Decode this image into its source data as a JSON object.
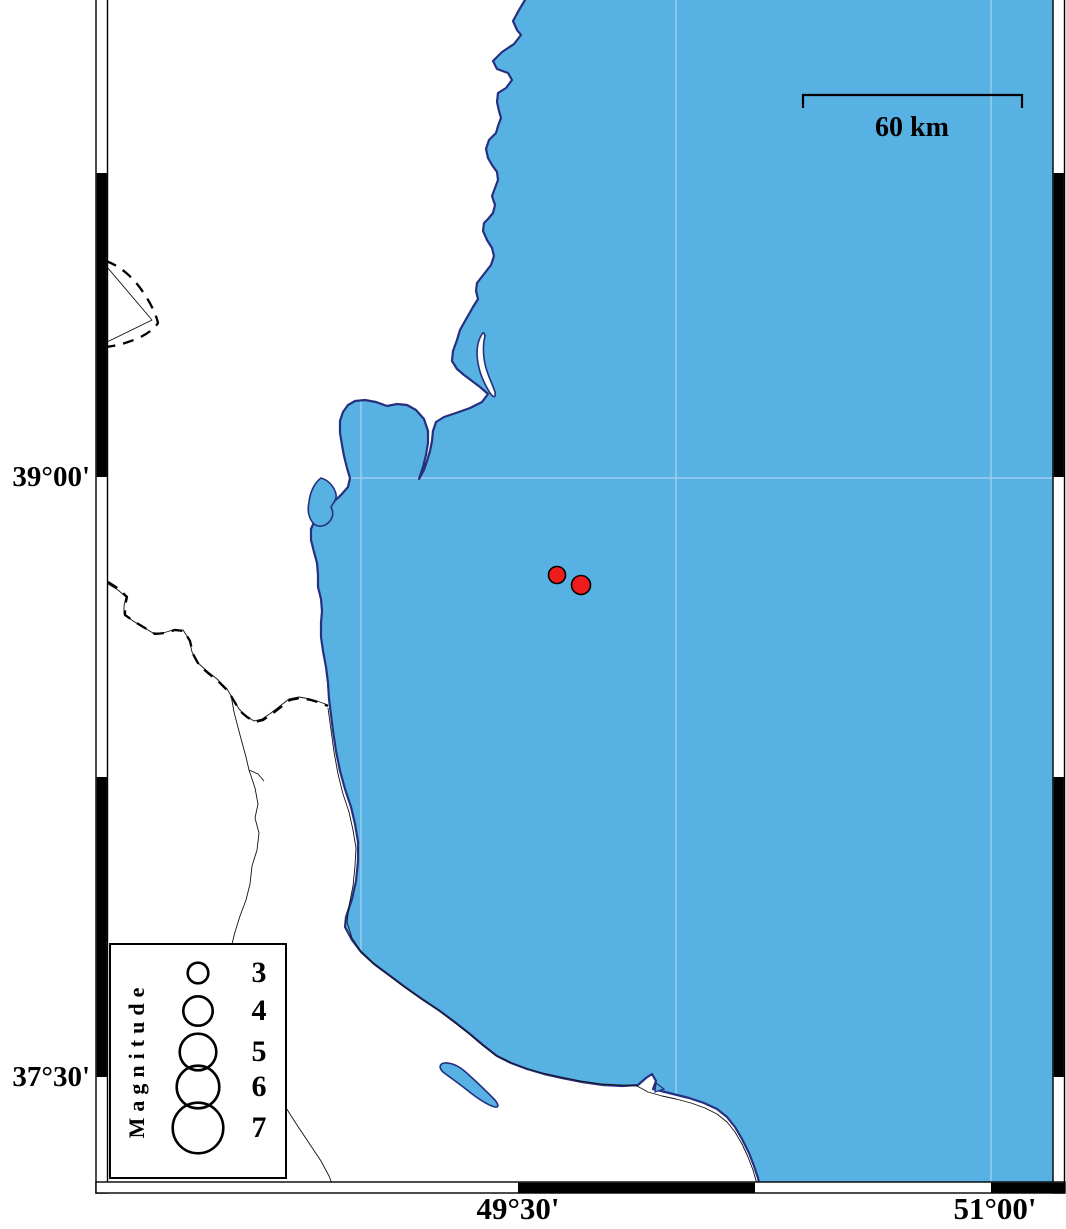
{
  "axis": {
    "lat": [
      {
        "text": "39°00'"
      },
      {
        "text": "37°30'"
      }
    ],
    "lon": [
      {
        "text": "49°30'"
      },
      {
        "text": "51°00'"
      }
    ]
  },
  "scale_bar": {
    "label": "60 km",
    "length_km": 60
  },
  "legend": {
    "title": "Magnitude",
    "entries": [
      {
        "label": "3",
        "radius": 10.3
      },
      {
        "label": "4",
        "radius": 14.7
      },
      {
        "label": "5",
        "radius": 18.3
      },
      {
        "label": "6",
        "radius": 21.3
      },
      {
        "label": "7",
        "radius": 25.3
      }
    ]
  },
  "earthquakes": [
    {
      "x": 557,
      "y": 575,
      "radius": 8.5
    },
    {
      "x": 581,
      "y": 585,
      "radius": 9.5
    }
  ],
  "colors": {
    "sea": "#57B1E2",
    "coastline": "#26307F",
    "gridline": "#9FD0EF",
    "land": "#FFFFFF",
    "earthquake": "#EE1C1C",
    "frame": "#000000"
  }
}
